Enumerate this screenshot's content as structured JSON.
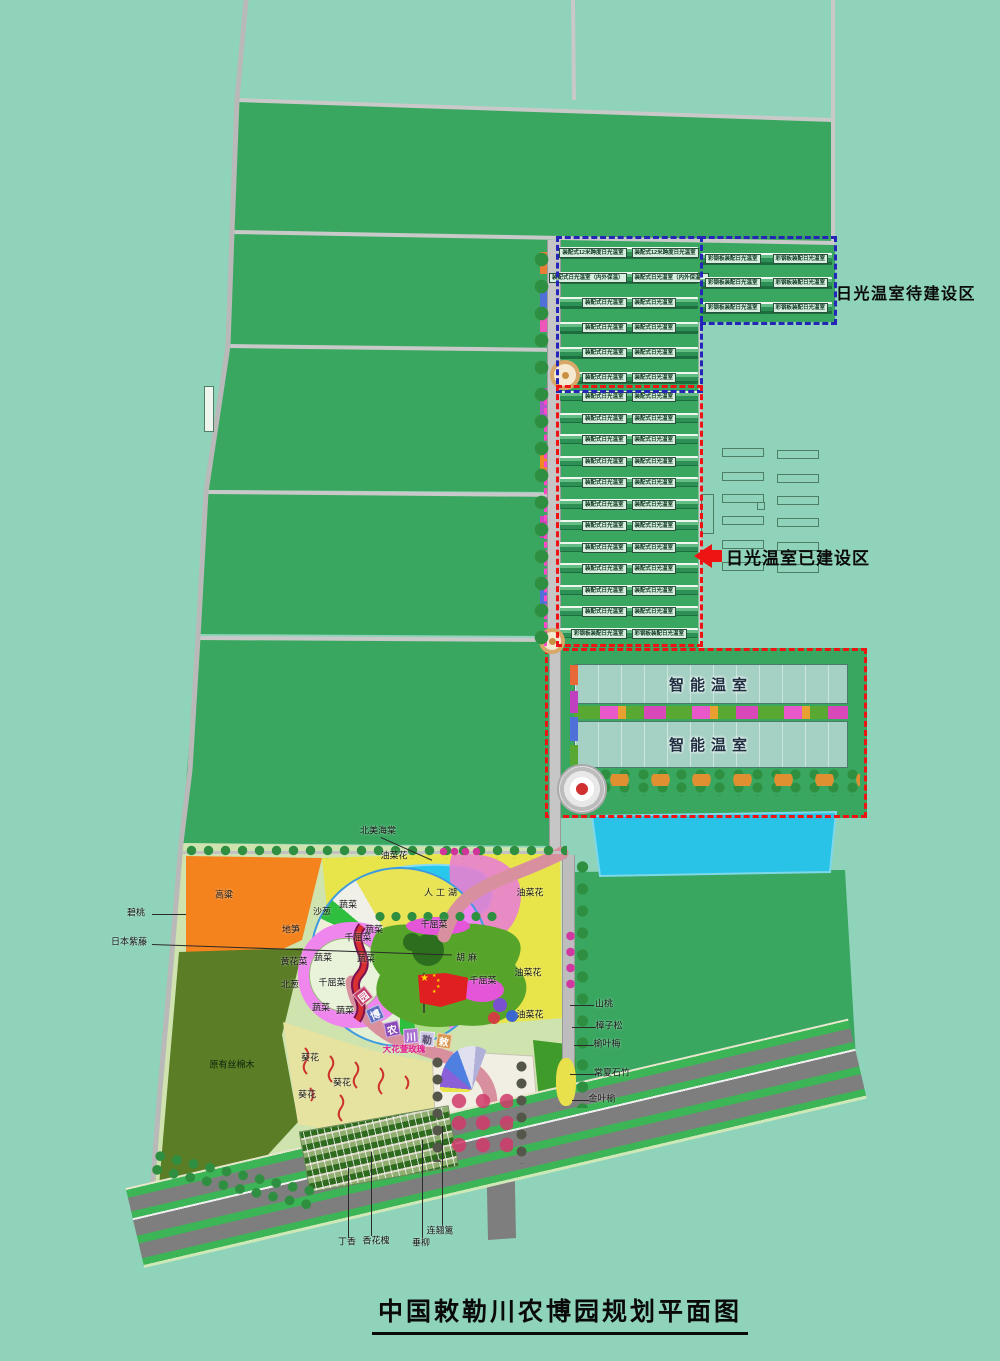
{
  "title": "中国敕勒川农博园规划平面图",
  "callouts": {
    "blue_zone": "日光温室待建设区",
    "red_zone": "日光温室已建设区"
  },
  "smart_greenhouse": {
    "label_top": "智能温室",
    "label_bottom": "智能温室"
  },
  "greenhouses": {
    "blue_left_rows": [
      [
        "装配式12米跨度日光温室",
        "装配式12米跨度日光温室"
      ],
      [
        "装配式日光温室（内外保温）",
        "装配式日光温室（内外保温）"
      ],
      [
        "装配式日光温室",
        "装配式日光温室"
      ],
      [
        "装配式日光温室",
        "装配式日光温室"
      ],
      [
        "装配式日光温室",
        "装配式日光温室"
      ],
      [
        "装配式日光温室",
        "装配式日光温室"
      ]
    ],
    "blue_right_rows": [
      [
        "彩钢板装配日光温室",
        "彩钢板装配日光温室"
      ],
      [
        "彩钢板装配日光温室",
        "彩钢板装配日光温室"
      ],
      [
        "彩钢板装配日光温室",
        "彩钢板装配日光温室"
      ]
    ],
    "red_rows": [
      [
        "装配式日光温室",
        "装配式日光温室"
      ],
      [
        "装配式日光温室",
        "装配式日光温室"
      ],
      [
        "装配式日光温室",
        "装配式日光温室"
      ],
      [
        "装配式日光温室",
        "装配式日光温室"
      ],
      [
        "装配式日光温室",
        "装配式日光温室"
      ],
      [
        "装配式日光温室",
        "装配式日光温室"
      ],
      [
        "装配式日光温室",
        "装配式日光温室"
      ],
      [
        "装配式日光温室",
        "装配式日光温室"
      ],
      [
        "装配式日光温室",
        "装配式日光温室"
      ],
      [
        "装配式日光温室",
        "装配式日光温室"
      ],
      [
        "装配式日光温室",
        "装配式日光温室"
      ],
      [
        "彩钢板装配日光温室",
        "彩钢板装配日光温室"
      ]
    ]
  },
  "park": {
    "labels": [
      {
        "t": "北美海棠",
        "x": 378,
        "y": 830,
        "line": {
          "x": 381,
          "y": 837,
          "w": 56,
          "r": 24
        }
      },
      {
        "t": "碧桃",
        "x": 136,
        "y": 912,
        "line": {
          "x": 152,
          "y": 914,
          "w": 34
        }
      },
      {
        "t": "日本紫藤",
        "x": 129,
        "y": 941,
        "line": {
          "x": 152,
          "y": 944,
          "w": 300,
          "r": 2
        }
      },
      {
        "t": "原有丝棉木",
        "x": 232,
        "y": 1064,
        "c": "on-dark"
      },
      {
        "t": "高粱",
        "x": 224,
        "y": 894
      },
      {
        "t": "油菜花",
        "x": 394,
        "y": 855
      },
      {
        "t": "沙葱",
        "x": 322,
        "y": 911
      },
      {
        "t": "蔬菜",
        "x": 348,
        "y": 904
      },
      {
        "t": "地笋",
        "x": 291,
        "y": 929
      },
      {
        "t": "黄花菜",
        "x": 294,
        "y": 961
      },
      {
        "t": "北葱",
        "x": 290,
        "y": 984
      },
      {
        "t": "蔬菜",
        "x": 323,
        "y": 957
      },
      {
        "t": "千屈菜",
        "x": 358,
        "y": 937
      },
      {
        "t": "蔬菜",
        "x": 374,
        "y": 929
      },
      {
        "t": "蔬菜",
        "x": 366,
        "y": 958
      },
      {
        "t": "千屈菜",
        "x": 332,
        "y": 982
      },
      {
        "t": "蔬菜",
        "x": 321,
        "y": 1007
      },
      {
        "t": "蔬菜",
        "x": 345,
        "y": 1010
      },
      {
        "t": "人工湖",
        "x": 442,
        "y": 892,
        "c": "spaced"
      },
      {
        "t": "千屈菜",
        "x": 434,
        "y": 924
      },
      {
        "t": "胡麻",
        "x": 468,
        "y": 957,
        "c": "spaced"
      },
      {
        "t": "油菜花",
        "x": 530,
        "y": 892
      },
      {
        "t": "油菜花",
        "x": 528,
        "y": 972
      },
      {
        "t": "千屈菜",
        "x": 483,
        "y": 980
      },
      {
        "t": "油菜花",
        "x": 530,
        "y": 1014
      },
      {
        "t": "葵花",
        "x": 310,
        "y": 1057
      },
      {
        "t": "葵花",
        "x": 342,
        "y": 1082
      },
      {
        "t": "葵花",
        "x": 307,
        "y": 1094
      },
      {
        "t": "大花萱玫瑰",
        "x": 404,
        "y": 1049,
        "c": "pink"
      },
      {
        "t": "山桃",
        "x": 604,
        "y": 1003,
        "line": {
          "x": 570,
          "y": 1005,
          "w": 24
        }
      },
      {
        "t": "樟子松",
        "x": 609,
        "y": 1025,
        "line": {
          "x": 572,
          "y": 1027,
          "w": 24
        }
      },
      {
        "t": "榆叶梅",
        "x": 607,
        "y": 1043,
        "line": {
          "x": 574,
          "y": 1045,
          "w": 20
        }
      },
      {
        "t": "常夏石竹",
        "x": 612,
        "y": 1072,
        "line": {
          "x": 570,
          "y": 1074,
          "w": 28
        }
      },
      {
        "t": "金叶榆",
        "x": 602,
        "y": 1098,
        "line": {
          "x": 572,
          "y": 1100,
          "w": 18
        }
      },
      {
        "t": "丁香",
        "x": 347,
        "y": 1241,
        "line": {
          "x": 348,
          "y": 1168,
          "h": 70
        }
      },
      {
        "t": "香花槐",
        "x": 376,
        "y": 1240,
        "line": {
          "x": 371,
          "y": 1152,
          "h": 84
        }
      },
      {
        "t": "垂柳",
        "x": 421,
        "y": 1242,
        "line": {
          "x": 422,
          "y": 1140,
          "h": 98
        }
      },
      {
        "t": "连翘篱",
        "x": 440,
        "y": 1230,
        "line": {
          "x": 442,
          "y": 1126,
          "h": 100
        }
      }
    ],
    "arc_blocks": [
      {
        "t": "园",
        "x": 363,
        "y": 996,
        "r": -38,
        "color": "#c23a68"
      },
      {
        "t": "博",
        "x": 375,
        "y": 1014,
        "r": -24,
        "color": "#5b6cc0"
      },
      {
        "t": "农",
        "x": 392,
        "y": 1029,
        "r": -12,
        "color": "#8a49b8"
      },
      {
        "t": "川",
        "x": 411,
        "y": 1036,
        "r": -4,
        "color": "#a96fd0"
      },
      {
        "t": "勒",
        "x": 427,
        "y": 1039,
        "r": 4,
        "color": "#cdc6e4",
        "tc": "#554a6a"
      },
      {
        "t": "敕",
        "x": 444,
        "y": 1041,
        "r": 8,
        "color": "#d89750"
      }
    ]
  },
  "colors": {
    "bg": "#8ed3ba",
    "field": "#3aa761",
    "road": "#c9c9c9",
    "blue_dash": "#2525b8",
    "red_dash": "#ee1414",
    "pink_dash": "#ff47c8",
    "pill_bg": "#d8efdf",
    "smart_glass": "#a5d0c4",
    "water": "#2ac3e8",
    "lake": "#28c8ec",
    "rape_yellow": "#e8e54a",
    "sorghum_orange": "#f5831d",
    "dark_field": "#5a7d26",
    "sunflower": "#e6e2a0",
    "huma_green": "#56a42a",
    "magenta": "#e455d8",
    "path_rose": "#d9909e",
    "flag_red": "#e02020",
    "plaza": "#f1eee3",
    "road_gray": "#7e7e7e",
    "road_green": "#3cb557"
  }
}
